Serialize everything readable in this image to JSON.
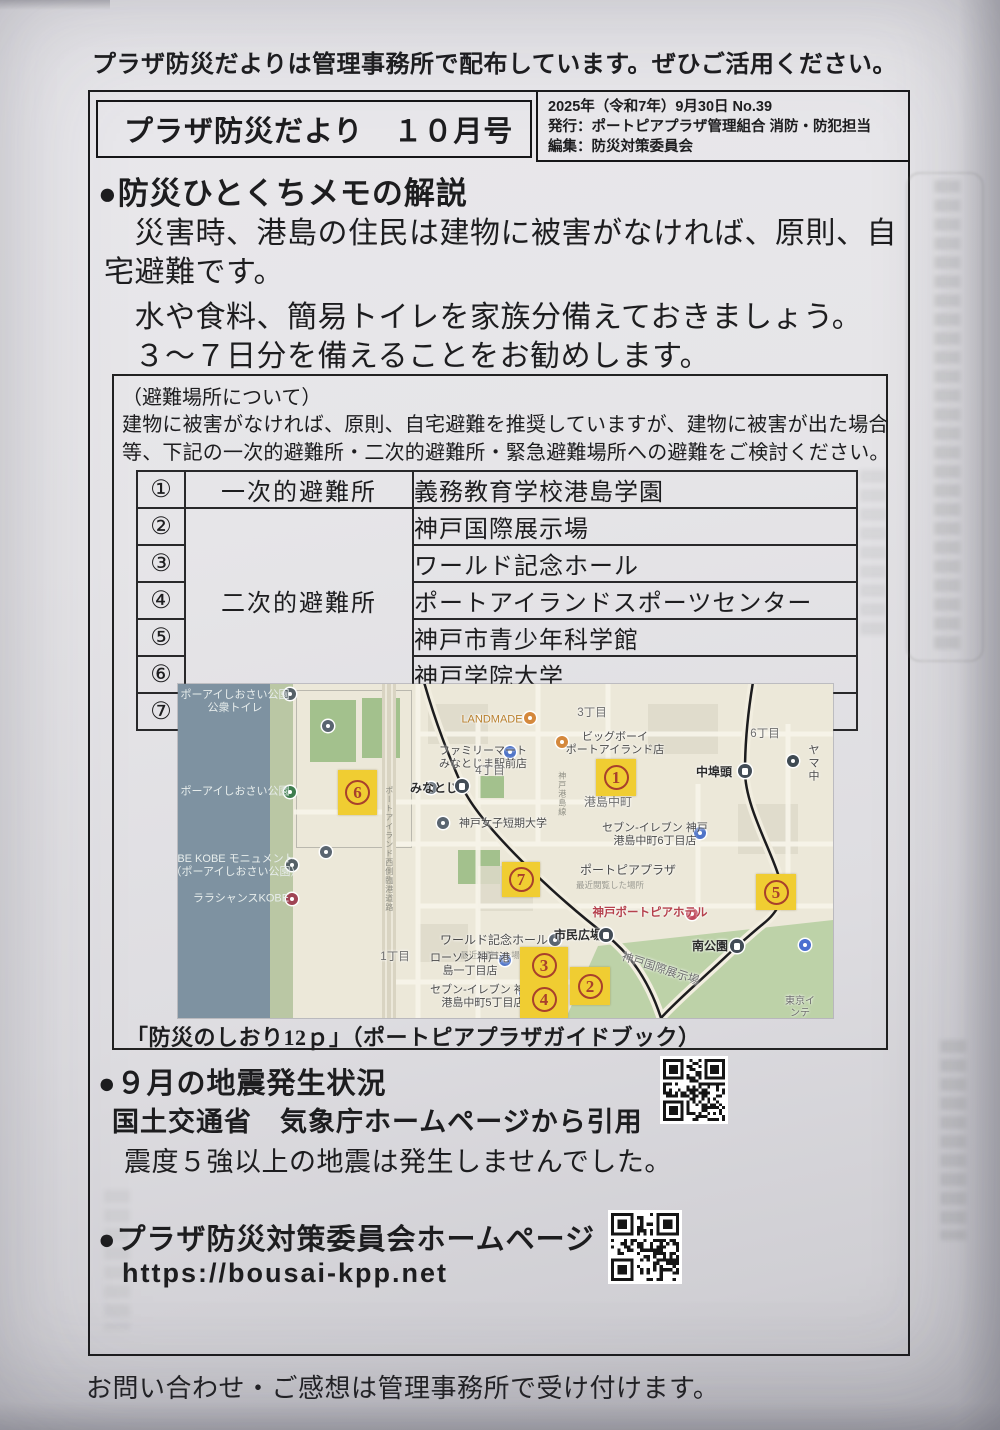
{
  "page": {
    "top_notice": "プラザ防災だよりは管理事務所で配布しています。ぜひご活用ください。",
    "footer": "お問い合わせ・ご感想は管理事務所で受け付けます。"
  },
  "header": {
    "title": "プラザ防災だより　１０月号",
    "date_line": "2025年（令和7年）9月30日 No.39",
    "publisher_line": "発行：ポートピアプラザ管理組合 消防・防犯担当",
    "editor_line": "編集：防災対策委員会"
  },
  "memo": {
    "heading": "●防災ひとくちメモの解説",
    "lines": [
      "　災害時、港島の住民は建物に被害がなければ、原則、自",
      "宅避難です。",
      "　水や食料、簡易トイレを家族分備えておきましょう。",
      "　３～７日分を備えることをお勧めします。"
    ]
  },
  "shelter": {
    "title": "（避難場所について）",
    "desc1": "建物に被害がなければ、原則、自宅避難を推奨していますが、建物に被害が出た場合",
    "desc2": "等、下記の一次的避難所・二次的避難所・緊急避難場所への避難をご検討ください。",
    "categories": {
      "primary": "一次的避難所",
      "secondary": "二次的避難所",
      "emergency": "緊急避難場所"
    },
    "rows": [
      {
        "num": "①",
        "name": "義務教育学校港島学園"
      },
      {
        "num": "②",
        "name": "神戸国際展示場"
      },
      {
        "num": "③",
        "name": "ワールド記念ホール"
      },
      {
        "num": "④",
        "name": "ポートアイランドスポーツセンター"
      },
      {
        "num": "⑤",
        "name": "神戸市青少年科学館"
      },
      {
        "num": "⑥",
        "name": "神戸学院大学"
      },
      {
        "num": "⑦",
        "name": "C棟3階コミュニティールーム"
      }
    ],
    "caption": "「防災のしおり12ｐ」（ポートピアプラザガイドブック）"
  },
  "map": {
    "markers": [
      {
        "n": "6",
        "x": 160,
        "y": 86,
        "w": 39,
        "h": 45
      },
      {
        "n": "1",
        "x": 418,
        "y": 75,
        "w": 40,
        "h": 37
      },
      {
        "n": "7",
        "x": 324,
        "y": 178,
        "w": 38,
        "h": 35
      },
      {
        "n": "5",
        "x": 578,
        "y": 190,
        "w": 40,
        "h": 36
      },
      {
        "n": "3",
        "n2": "4",
        "x": 342,
        "y": 263,
        "w": 48,
        "h": 71
      },
      {
        "n": "2",
        "x": 392,
        "y": 283,
        "w": 40,
        "h": 38
      }
    ],
    "stations": [
      {
        "x": 284,
        "y": 102
      },
      {
        "x": 567,
        "y": 87
      },
      {
        "x": 428,
        "y": 251
      },
      {
        "x": 559,
        "y": 262
      }
    ],
    "pois": [
      {
        "x": 352,
        "y": 34,
        "bg": "#d4883c"
      },
      {
        "x": 332,
        "y": 68,
        "bg": "#4f74c8"
      },
      {
        "x": 384,
        "y": 58,
        "bg": "#d4883c"
      },
      {
        "x": 253,
        "y": 104,
        "bg": "#5a6570"
      },
      {
        "x": 265,
        "y": 139,
        "bg": "#5a6570"
      },
      {
        "x": 522,
        "y": 149,
        "bg": "#4f74c8"
      },
      {
        "x": 615,
        "y": 77,
        "bg": "#3f4a52"
      },
      {
        "x": 514,
        "y": 230,
        "bg": "#c0485c"
      },
      {
        "x": 377,
        "y": 256,
        "bg": "#5a6570"
      },
      {
        "x": 327,
        "y": 276,
        "bg": "#4f74c8"
      },
      {
        "x": 347,
        "y": 309,
        "bg": "#4f74c8"
      },
      {
        "x": 627,
        "y": 261,
        "bg": "#4a6fd0"
      },
      {
        "x": 112,
        "y": 10,
        "bg": "#556066"
      },
      {
        "x": 112,
        "y": 108,
        "bg": "#3e7d4e"
      },
      {
        "x": 114,
        "y": 181,
        "bg": "#556066"
      },
      {
        "x": 114,
        "y": 215,
        "bg": "#a04454"
      },
      {
        "x": 150,
        "y": 42,
        "bg": "#5a6570"
      },
      {
        "x": 148,
        "y": 168,
        "bg": "#5a6570"
      }
    ],
    "labels": [
      {
        "t": "ポーアイしおさい公園\n公衆トイレ",
        "x": 57,
        "y": 18,
        "cls": "wlab"
      },
      {
        "t": "ポーアイしおさい公園",
        "x": 57,
        "y": 108,
        "cls": "wlab"
      },
      {
        "t": "BE KOBE モニュメント\n（ポーアイしおさい公園）",
        "x": 58,
        "y": 182,
        "cls": "wlab"
      },
      {
        "t": "ララシャンスKOBE",
        "x": 63,
        "y": 215,
        "cls": "wlab"
      },
      {
        "t": "LANDMADE",
        "x": 314,
        "y": 36,
        "color": "#b9802e"
      },
      {
        "t": "3丁目",
        "x": 414,
        "y": 30,
        "cls": "dist"
      },
      {
        "t": "6丁目",
        "x": 587,
        "y": 51,
        "cls": "dist"
      },
      {
        "t": "ファミリーマート\nみなとじま駅前店",
        "x": 305,
        "y": 74
      },
      {
        "t": "ビッグボーイ\nポートアイランド店",
        "x": 437,
        "y": 60
      },
      {
        "t": "4丁目",
        "x": 312,
        "y": 88,
        "cls": "dist"
      },
      {
        "t": "みなとじま",
        "x": 262,
        "y": 104,
        "cls": "big"
      },
      {
        "t": "港島中町",
        "x": 430,
        "y": 118,
        "cls": "dist",
        "fs": 12
      },
      {
        "t": "中埠頭",
        "x": 536,
        "y": 88,
        "cls": "big"
      },
      {
        "t": "ヤマ\n中",
        "x": 636,
        "y": 80
      },
      {
        "t": "セブン-イレブン 神戸\n港島中町6丁目店",
        "x": 477,
        "y": 151
      },
      {
        "t": "神戸女子短期大学",
        "x": 325,
        "y": 140
      },
      {
        "t": "ポートピアプラザ",
        "x": 450,
        "y": 186,
        "fs": 12
      },
      {
        "t": "最近閲覧した場所",
        "x": 432,
        "y": 201,
        "cls": "tiny"
      },
      {
        "t": "神戸ポートピアホテル",
        "x": 472,
        "y": 230,
        "cls": "red"
      },
      {
        "t": "市民広場",
        "x": 400,
        "y": 251,
        "cls": "big"
      },
      {
        "t": "ワールド記念ホール",
        "x": 316,
        "y": 256,
        "fs": 12
      },
      {
        "t": "最近閲覧した場",
        "x": 312,
        "y": 271,
        "cls": "tiny"
      },
      {
        "t": "神戸国際展示場",
        "x": 482,
        "y": 286,
        "cls": "dist",
        "rot": 18
      },
      {
        "t": "南公園",
        "x": 532,
        "y": 262,
        "cls": "big"
      },
      {
        "t": "1丁目",
        "x": 217,
        "y": 274,
        "cls": "dist"
      },
      {
        "t": "ローソン 神戸港\n島一丁目店",
        "x": 292,
        "y": 281
      },
      {
        "t": "セブン-イレブン 神戸\n港島中町5丁目店",
        "x": 305,
        "y": 313
      },
      {
        "t": "東京インテ",
        "x": 622,
        "y": 324,
        "cls": "dist",
        "fs": 10
      },
      {
        "t": "ポートアイランド西側臨港道路",
        "x": 211,
        "y": 165,
        "cls": "vroad"
      },
      {
        "t": "神戸港島線",
        "x": 384,
        "y": 110,
        "cls": "vroad"
      }
    ]
  },
  "quake": {
    "heading": "●９月の地震発生状況",
    "source": "国土交通省　気象庁ホームページから引用",
    "result": "震度５強以上の地震は発生しませんでした。"
  },
  "homepage": {
    "heading": "●プラザ防災対策委員会ホームページ",
    "url": "https://bousai-kpp.net"
  }
}
